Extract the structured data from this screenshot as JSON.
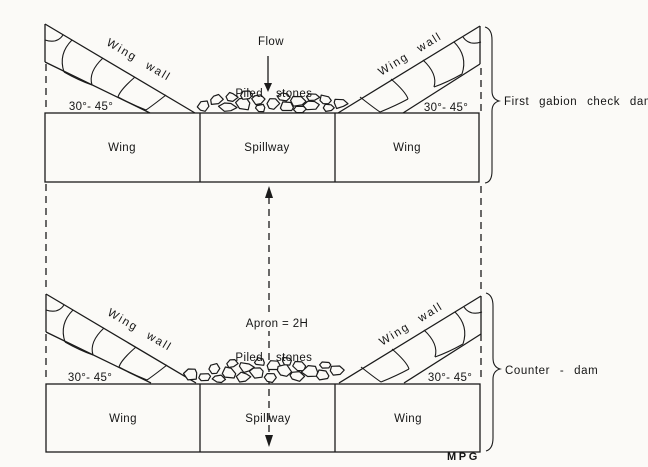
{
  "figure_labels": {
    "flow": "Flow",
    "apron": "Apron = 2H",
    "credit": "MPG"
  },
  "first_dam": {
    "brace_label": "First gabion check dam",
    "piled_stones": [
      "Piled",
      "stones"
    ],
    "wing_wall_left": "Wing wall",
    "wing_wall_right": "Wing wall",
    "angle_left": "30°- 45°",
    "angle_right": "30°- 45°",
    "boxes": [
      "Wing",
      "Spillway",
      "Wing"
    ]
  },
  "counter_dam": {
    "brace_label": "Counter - dam",
    "piled_stones": [
      "Piled",
      "stones"
    ],
    "wing_wall_left": "Wing wall",
    "wing_wall_right": "Wing wall",
    "angle_left": "30°- 45°",
    "angle_right": "30°- 45°",
    "boxes": [
      "Wing",
      "Spillway",
      "Wing"
    ]
  }
}
